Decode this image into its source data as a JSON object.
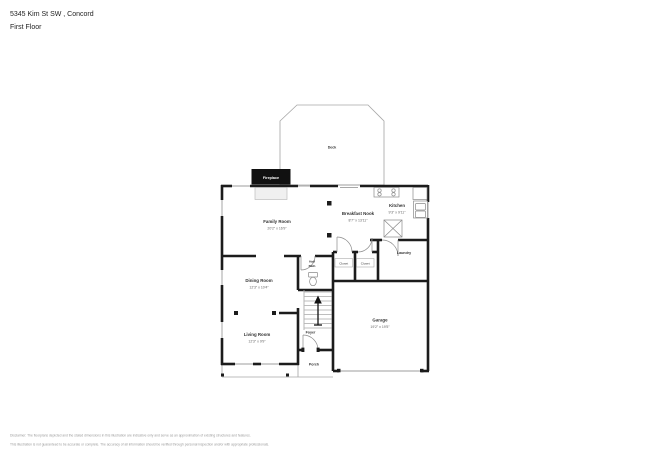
{
  "header": {
    "address": "5345 Kim St SW , Concord",
    "floor": "First Floor"
  },
  "plan": {
    "deck_label": "Deck",
    "fireplace_label": "Fireplace",
    "rooms": [
      {
        "name": "Family Room",
        "dims": "20'2\" x 16'9\""
      },
      {
        "name": "Breakfast Nook",
        "dims": "8'7\" x 13'11\""
      },
      {
        "name": "Kitchen",
        "dims": "9'3\" x 9'11\""
      },
      {
        "name": "Dining Room",
        "dims": "12'3\" x 10'4\""
      },
      {
        "name": "Living Room",
        "dims": "12'3\" x 9'9\""
      },
      {
        "name": "Garage",
        "dims": "19'2\" x 19'5\""
      }
    ],
    "small_labels": {
      "laundry": "Laundry",
      "half_bath_line1": "Half",
      "half_bath_line2": "Bath",
      "closet_left": "Closet",
      "closet_right": "Closet",
      "foyer": "Foyer",
      "porch": "Porch"
    }
  },
  "footer": {
    "disclaimer_line1": "Disclaimer: The floorplans depicted and the stated dimensions in this illustration are indicative only and serve as an approximation of existing structures and features.",
    "disclaimer_line2": "This illustration is not guaranteed to be accurate or complete. The accuracy of all information should be verified through personal inspection and/or with appropriate professionals.",
    "colors": {
      "wall": "#1c1c1c",
      "thin_line": "#9c9c9c",
      "label": "#333333"
    }
  }
}
